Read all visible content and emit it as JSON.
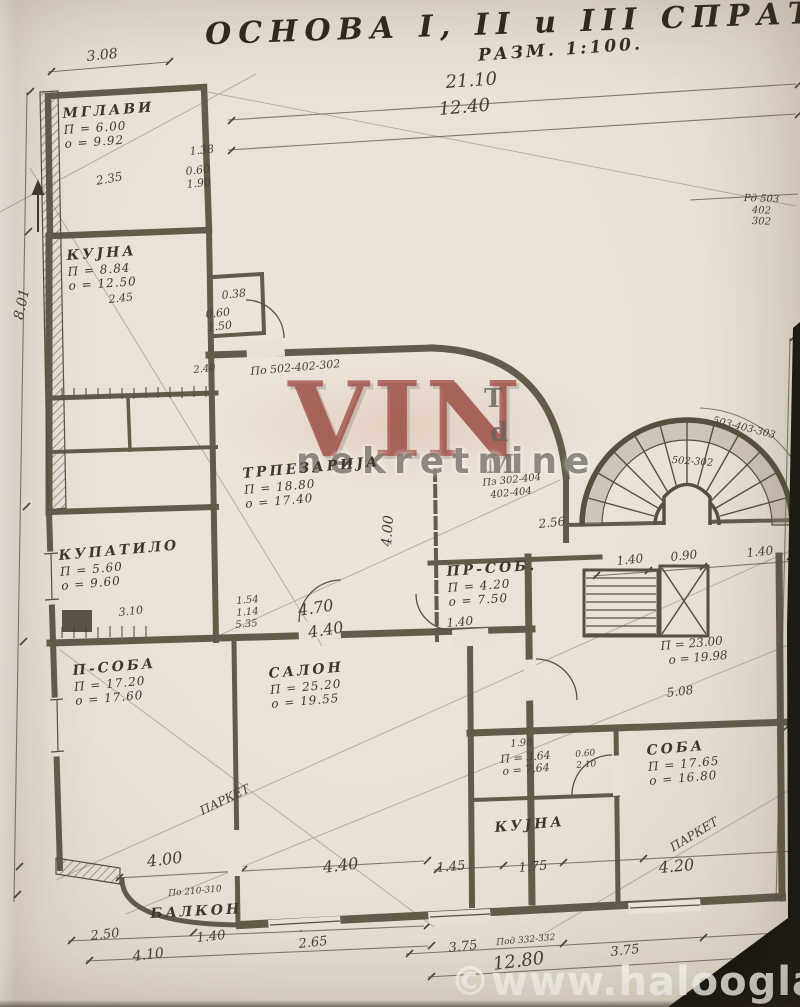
{
  "photo": {
    "paper_color": "#e8e1d6",
    "ink_color": "#57503f",
    "photo_edge_color": "#17150f",
    "watermark_red": "#96352c"
  },
  "title": {
    "main": "ОСНОВА I, II и III СПРАТА",
    "scale": "РАЗМ. 1:100."
  },
  "watermark": {
    "logo": "VIN",
    "subtitle": "nekretnine",
    "side_letters": [
      "T",
      "d",
      "M"
    ]
  },
  "footer": {
    "site": "©www.halooglasi.com"
  },
  "rooms": [
    {
      "name": "МГЛАВИ",
      "area": "П = 6.00",
      "perim": "о = 9.92",
      "x": 62,
      "y": 106,
      "r": -4
    },
    {
      "name": "КУЈНА",
      "area": "П = 8.84",
      "perim": "о = 12.50",
      "x": 66,
      "y": 248,
      "r": -4
    },
    {
      "name": "ТРПЕЗАРИЈА",
      "area": "П = 18.80",
      "perim": "о = 17.40",
      "x": 242,
      "y": 466,
      "r": -5
    },
    {
      "name": "КУПАТИЛО",
      "area": "П = 5.60",
      "perim": "о = 9.60",
      "x": 58,
      "y": 548,
      "r": -5
    },
    {
      "name": "П-СОБА",
      "area": "П = 17.20",
      "perim": "о = 17.60",
      "x": 72,
      "y": 663,
      "r": -5
    },
    {
      "name": "САЛОН",
      "area": "П = 25.20",
      "perim": "о = 19.55",
      "x": 268,
      "y": 666,
      "r": -5
    },
    {
      "name": "ПР-СОБ.",
      "area": "П = 4.20",
      "perim": "о = 7.50",
      "x": 446,
      "y": 564,
      "r": -4
    },
    {
      "name": "СОБА",
      "area": "П = 17.65",
      "perim": "о = 16.80",
      "x": 646,
      "y": 743,
      "r": -5
    },
    {
      "name": "КУЈНА",
      "area": "",
      "perim": "",
      "x": 494,
      "y": 820,
      "r": -5
    },
    {
      "name": "БАЛКОН",
      "area": "",
      "perim": "",
      "x": 150,
      "y": 906,
      "r": -3
    }
  ],
  "annotations": [
    {
      "t": "21.10",
      "x": 445,
      "y": 74,
      "r": -4,
      "s": 18
    },
    {
      "t": "12.40",
      "x": 438,
      "y": 101,
      "r": -5,
      "s": 18
    },
    {
      "t": "3.08",
      "x": 86,
      "y": 50,
      "r": -6,
      "s": 14
    },
    {
      "t": "8.01",
      "x": 12,
      "y": 318,
      "r": -78,
      "s": 14
    },
    {
      "t": "1.38",
      "x": 189,
      "y": 146,
      "r": -6,
      "s": 11
    },
    {
      "t": "0.60",
      "x": 185,
      "y": 166,
      "r": -6,
      "s": 11
    },
    {
      "t": "1.90",
      "x": 186,
      "y": 179,
      "r": -6,
      "s": 11
    },
    {
      "t": "2.35",
      "x": 95,
      "y": 175,
      "r": -10,
      "s": 12
    },
    {
      "t": "2.45",
      "x": 108,
      "y": 294,
      "r": -6,
      "s": 11
    },
    {
      "t": "0.38",
      "x": 221,
      "y": 290,
      "r": -6,
      "s": 11
    },
    {
      "t": "0.60",
      "x": 205,
      "y": 309,
      "r": -6,
      "s": 11
    },
    {
      "t": "1.50",
      "x": 207,
      "y": 322,
      "r": -6,
      "s": 11
    },
    {
      "t": "2.40",
      "x": 193,
      "y": 366,
      "r": -6,
      "s": 10
    },
    {
      "t": "По 502-402-302",
      "x": 250,
      "y": 366,
      "r": -5,
      "s": 11
    },
    {
      "t": "Пз 302-404",
      "x": 482,
      "y": 479,
      "r": -6,
      "s": 10
    },
    {
      "t": "402-404",
      "x": 490,
      "y": 491,
      "r": -6,
      "s": 10
    },
    {
      "t": "Рд 503",
      "x": 744,
      "y": 194,
      "r": 2,
      "s": 10
    },
    {
      "t": "402",
      "x": 752,
      "y": 206,
      "r": 2,
      "s": 10
    },
    {
      "t": "302",
      "x": 752,
      "y": 217,
      "r": 2,
      "s": 10
    },
    {
      "t": "503-403-303",
      "x": 714,
      "y": 416,
      "r": 14,
      "s": 10
    },
    {
      "t": "502-302",
      "x": 672,
      "y": 456,
      "r": 4,
      "s": 10
    },
    {
      "t": "4.00",
      "x": 380,
      "y": 546,
      "r": -86,
      "s": 14
    },
    {
      "t": "1.54",
      "x": 236,
      "y": 597,
      "r": -5,
      "s": 10
    },
    {
      "t": "1.14",
      "x": 236,
      "y": 609,
      "r": -5,
      "s": 10
    },
    {
      "t": "5.35",
      "x": 235,
      "y": 621,
      "r": -5,
      "s": 10
    },
    {
      "t": "4.70",
      "x": 297,
      "y": 603,
      "r": -9,
      "s": 16
    },
    {
      "t": "4.40",
      "x": 307,
      "y": 625,
      "r": -9,
      "s": 16
    },
    {
      "t": "1.40",
      "x": 446,
      "y": 617,
      "r": -5,
      "s": 12
    },
    {
      "t": "2.56",
      "x": 538,
      "y": 518,
      "r": -6,
      "s": 12
    },
    {
      "t": "1.40",
      "x": 616,
      "y": 555,
      "r": -6,
      "s": 12
    },
    {
      "t": "0.90",
      "x": 670,
      "y": 551,
      "r": -6,
      "s": 12
    },
    {
      "t": "1.40",
      "x": 746,
      "y": 547,
      "r": -6,
      "s": 12
    },
    {
      "t": "П = 23.00",
      "x": 660,
      "y": 640,
      "r": -5,
      "s": 12
    },
    {
      "t": "о = 19.98",
      "x": 668,
      "y": 654,
      "r": -5,
      "s": 12
    },
    {
      "t": "5.08",
      "x": 666,
      "y": 687,
      "r": -7,
      "s": 12
    },
    {
      "t": "3.10",
      "x": 118,
      "y": 607,
      "r": -6,
      "s": 11
    },
    {
      "t": "П = 3.64",
      "x": 500,
      "y": 754,
      "r": -5,
      "s": 11
    },
    {
      "t": "о = 7.64",
      "x": 502,
      "y": 766,
      "r": -5,
      "s": 11
    },
    {
      "t": "1.98",
      "x": 510,
      "y": 740,
      "r": -5,
      "s": 10
    },
    {
      "t": "0.60",
      "x": 575,
      "y": 751,
      "r": -5,
      "s": 9
    },
    {
      "t": "2.10",
      "x": 576,
      "y": 762,
      "r": -5,
      "s": 9
    },
    {
      "t": "1.45",
      "x": 436,
      "y": 862,
      "r": -5,
      "s": 13
    },
    {
      "t": "1.75",
      "x": 518,
      "y": 862,
      "r": -5,
      "s": 13
    },
    {
      "t": "4.00",
      "x": 146,
      "y": 854,
      "r": -7,
      "s": 16
    },
    {
      "t": "4.40",
      "x": 322,
      "y": 860,
      "r": -7,
      "s": 16
    },
    {
      "t": "4.20",
      "x": 658,
      "y": 860,
      "r": -5,
      "s": 16
    },
    {
      "t": "По 210-310",
      "x": 168,
      "y": 890,
      "r": -5,
      "s": 9
    },
    {
      "t": "2.50",
      "x": 90,
      "y": 930,
      "r": -6,
      "s": 13
    },
    {
      "t": "1.40",
      "x": 196,
      "y": 932,
      "r": -6,
      "s": 13
    },
    {
      "t": "2.65",
      "x": 298,
      "y": 938,
      "r": -6,
      "s": 13
    },
    {
      "t": "4.10",
      "x": 132,
      "y": 950,
      "r": -7,
      "s": 14
    },
    {
      "t": "3.75",
      "x": 448,
      "y": 942,
      "r": -6,
      "s": 13
    },
    {
      "t": "Под 332-332",
      "x": 496,
      "y": 939,
      "r": -5,
      "s": 9
    },
    {
      "t": "12.80",
      "x": 492,
      "y": 956,
      "r": -7,
      "s": 18
    },
    {
      "t": "3.75",
      "x": 610,
      "y": 946,
      "r": -6,
      "s": 13
    },
    {
      "t": "2.",
      "x": 768,
      "y": 944,
      "r": -6,
      "s": 13
    },
    {
      "t": "ПАРКЕТ",
      "x": 198,
      "y": 806,
      "r": -26,
      "s": 12
    },
    {
      "t": "ПАРКЕТ",
      "x": 668,
      "y": 843,
      "r": -31,
      "s": 12
    }
  ]
}
